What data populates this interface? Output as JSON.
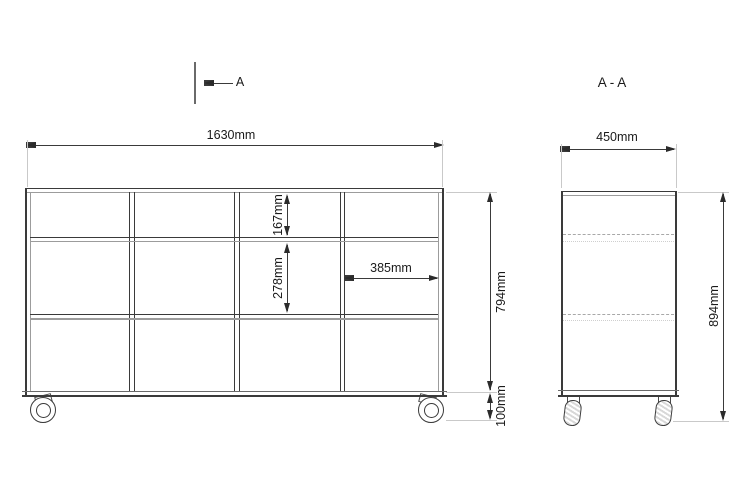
{
  "colors": {
    "line": "#3a3a3a",
    "line_secondary": "#9c9c9c",
    "hidden_line": "#a8a8a8",
    "text": "#1a1a1a",
    "background": "#ffffff"
  },
  "section_marker": {
    "label": "A"
  },
  "views": {
    "front": {
      "grid": {
        "columns": 4,
        "rows": 3
      },
      "dimensions": {
        "overall_width": "1630mm",
        "body_height": "794mm",
        "caster_height": "100mm",
        "top_opening_height": "167mm",
        "middle_opening_height": "278mm",
        "compartment_width": "385mm"
      }
    },
    "side": {
      "title": "A - A",
      "dimensions": {
        "depth": "450mm",
        "overall_height": "894mm"
      }
    }
  }
}
